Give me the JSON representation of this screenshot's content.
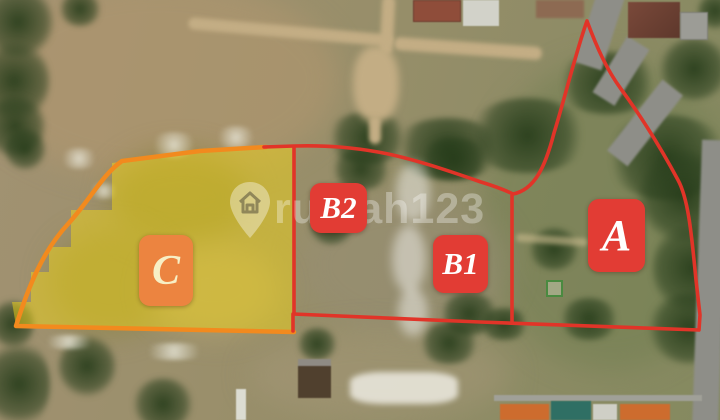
{
  "photo": {
    "description": "Aerial drone photo of a land site divided into labeled plots",
    "watermark": {
      "text": "rumah123",
      "icon": "map-pin-house-icon",
      "color": "rgba(255,255,255,0.32)"
    },
    "boundary_color": "#e13428",
    "zones": {
      "a": {
        "label": "A",
        "box_color": "#e23c34",
        "text_color": "#ffffff"
      },
      "b1": {
        "label": "B1",
        "box_color": "#e23c34",
        "text_color": "#ffffff"
      },
      "b2": {
        "label": "B2",
        "box_color": "#e23c34",
        "text_color": "#ffffff"
      },
      "c": {
        "label": "C",
        "box_color": "#ec8440",
        "text_color": "#f7efc5",
        "fill_color": "rgba(240,212,24,0.5)",
        "border_color": "#f28a1e"
      }
    }
  }
}
